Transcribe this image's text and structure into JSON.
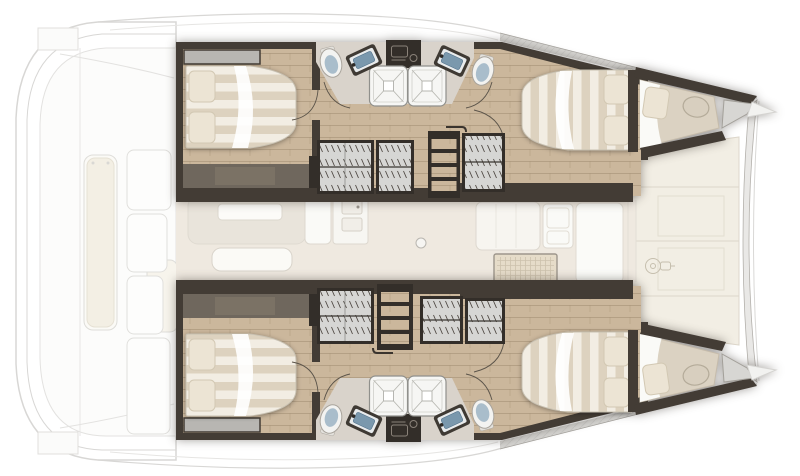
{
  "boat": {
    "type": "catamaran-floor-plan",
    "view": "top-down-deck-plan",
    "orientation": "bow-right"
  },
  "palette": {
    "wall": "#433c35",
    "walldark": "#332e29",
    "wood": "#cbb79c",
    "woodline": "#b3a084",
    "bathfloor": "#d9d3cb",
    "saloonfloor": "#efe9e0",
    "deckcream": "#f2eee4",
    "deckgray": "#d7d6d3",
    "outline": "#d8d7d5",
    "duvet": "#f2ede3",
    "duvetstripe": "#ddd2bf",
    "pillow": "#ece4d4",
    "pillowedge": "#d2c8b3",
    "lockerfill": "#d6d6d4",
    "lockerhatch": "#4e4842",
    "shower": "#f6f6f4",
    "showerline": "#b8b8b2",
    "sinkbasin": "#7a98ad",
    "toiletbowl": "#a9bdcb",
    "porcelain": "#f3f3f1",
    "sofaband": "#6f675d",
    "headboard": "#b8b6b2",
    "forepeakcushion": "#dbd2c2",
    "wovenmat": "#e6dcc9",
    "wovenline": "#cdc2ad",
    "faintfill": "#e9e4db",
    "faintstroke": "#d9d4cb"
  },
  "areas": {
    "aft_deck": {
      "name": "aft-deck-cockpit",
      "items": [
        "bench-seat",
        "seat-cushion",
        "deck-panels",
        "transom-steps"
      ]
    },
    "port_hull": {
      "name": "port-hull",
      "rooms": [
        {
          "name": "aft-cabin",
          "items": [
            "double-berth",
            "pillow",
            "pillow",
            "headboard-shelf",
            "side-sofa",
            "door-swing"
          ]
        },
        {
          "name": "aft-bathroom",
          "items": [
            "toilet",
            "washbasin",
            "shower"
          ]
        },
        {
          "name": "passageway",
          "items": [
            "wardrobe-locker",
            "wardrobe-locker",
            "companionway-steps",
            "wardrobe-locker"
          ]
        },
        {
          "name": "forward-bathroom",
          "items": [
            "shower",
            "washbasin",
            "toilet"
          ]
        },
        {
          "name": "forward-cabin",
          "items": [
            "double-berth",
            "pillow",
            "pillow"
          ]
        },
        {
          "name": "forepeak-berth",
          "items": [
            "single-berth",
            "pillow",
            "deck-hatch"
          ]
        }
      ]
    },
    "starboard_hull": {
      "name": "starboard-hull",
      "rooms": [
        {
          "name": "aft-cabin",
          "items": [
            "double-berth",
            "pillow",
            "pillow",
            "headboard-shelf",
            "side-sofa",
            "door-swing"
          ]
        },
        {
          "name": "aft-bathroom",
          "items": [
            "toilet",
            "washbasin",
            "shower"
          ]
        },
        {
          "name": "passageway",
          "items": [
            "wardrobe-locker",
            "companionway-steps",
            "wardrobe-locker",
            "wardrobe-locker"
          ]
        },
        {
          "name": "forward-bathroom",
          "items": [
            "shower",
            "washbasin",
            "toilet"
          ]
        },
        {
          "name": "forward-cabin",
          "items": [
            "double-berth",
            "pillow",
            "pillow"
          ]
        },
        {
          "name": "forepeak-berth",
          "items": [
            "single-berth",
            "pillow",
            "deck-hatch"
          ]
        }
      ]
    },
    "saloon": {
      "items": [
        "sofa",
        "table",
        "bench",
        "galley-counter",
        "galley-sink",
        "mast-post",
        "sideboard",
        "forward-door"
      ]
    },
    "forward_cockpit": {
      "items": [
        "lounge-panels",
        "cockpit-table",
        "windlass"
      ]
    },
    "bow": {
      "items": [
        "crossbeam",
        "hull-tip",
        "hull-tip"
      ]
    }
  },
  "counts": {
    "cabins": 4,
    "bathrooms": 4,
    "showers": 4,
    "toilets": 4,
    "washbasins": 4,
    "double_berths": 4,
    "forepeak_berths": 2,
    "companionway_steps": 2,
    "wardrobes": 6
  }
}
